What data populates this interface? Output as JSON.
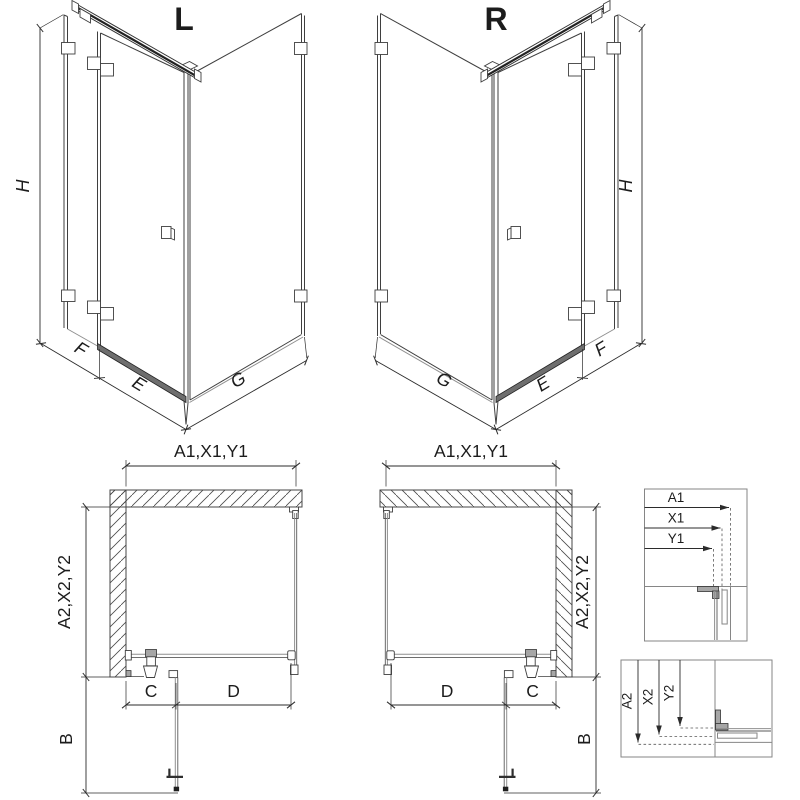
{
  "views": {
    "left3d": {
      "label": "L",
      "dim_height": "H",
      "dim_fixed": "F",
      "dim_door": "E",
      "dim_side": "G"
    },
    "right3d": {
      "label": "R",
      "dim_height": "H",
      "dim_fixed": "F",
      "dim_door": "E",
      "dim_side": "G"
    }
  },
  "plans": {
    "left": {
      "dim_width": "A1,X1,Y1",
      "dim_depth": "A2,X2,Y2",
      "dim_b": "B",
      "dim_c": "C",
      "dim_d": "D"
    },
    "right": {
      "dim_width": "A1,X1,Y1",
      "dim_depth": "A2,X2,Y2",
      "dim_b": "B",
      "dim_c": "C",
      "dim_d": "D"
    }
  },
  "details": {
    "width": {
      "a1": "A1",
      "x1": "X1",
      "y1": "Y1"
    },
    "depth": {
      "a2": "A2",
      "x2": "X2",
      "y2": "Y2"
    }
  },
  "colors": {
    "line": "#3f3f3f",
    "glass": "#8f8f8f",
    "dimension": "#2b2b2b",
    "background": "#ffffff"
  }
}
